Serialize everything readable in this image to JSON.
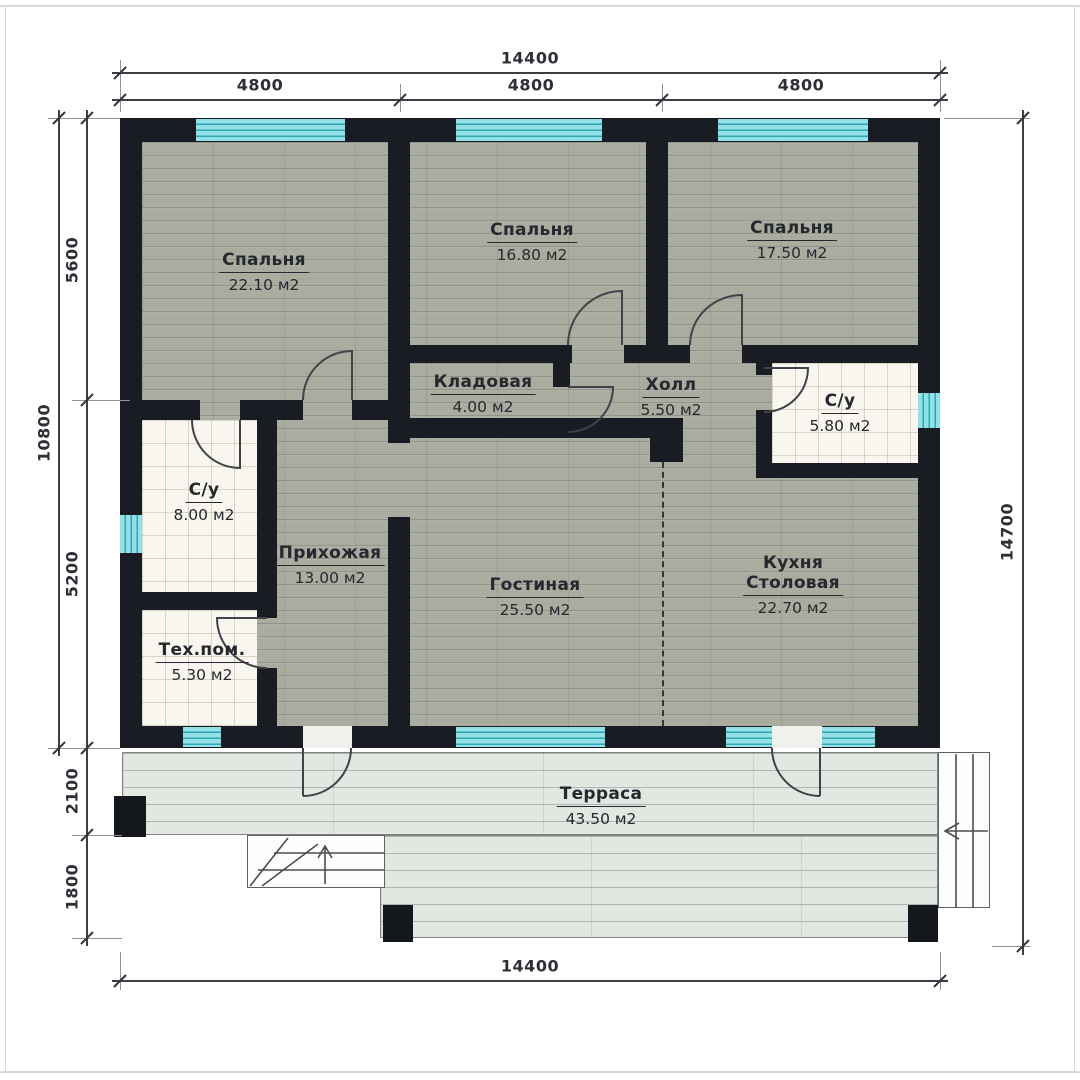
{
  "rooms": [
    {
      "name": "Спальня",
      "area": "22.10 м2"
    },
    {
      "name": "Спальня",
      "area": "16.80 м2"
    },
    {
      "name": "Спальня",
      "area": "17.50 м2"
    },
    {
      "name": "Кладовая",
      "area": "4.00 м2"
    },
    {
      "name": "Холл",
      "area": "5.50 м2"
    },
    {
      "name": "С/у",
      "area": "5.80 м2"
    },
    {
      "name": "С/у",
      "area": "8.00 м2"
    },
    {
      "name": "Прихожая",
      "area": "13.00 м2"
    },
    {
      "name": "Тех.пом.",
      "area": "5.30 м2"
    },
    {
      "name": "Гостиная",
      "area": "25.50 м2"
    },
    {
      "name": "Кухня",
      "name_line2": "Столовая",
      "area": "22.70 м2"
    },
    {
      "name": "Терраса",
      "area": "43.50 м2"
    }
  ],
  "dimensions": {
    "top_total": "14400",
    "top_seg_1": "4800",
    "top_seg_2": "4800",
    "top_seg_3": "4800",
    "left_total": "10800",
    "left_seg_top": "5600",
    "left_seg_bottom": "5200",
    "terrace_depth": "2100",
    "terrace_lower": "1800",
    "right_total": "14700",
    "bottom_total": "14400"
  },
  "colors": {
    "wall": "#191c22",
    "window_fill": "#93e0e6",
    "window_line": "#2fa6b3",
    "floor_wood": "#a9ac9f",
    "floor_deck": "#e2e7e1",
    "floor_tile": "#f8f6ef"
  }
}
